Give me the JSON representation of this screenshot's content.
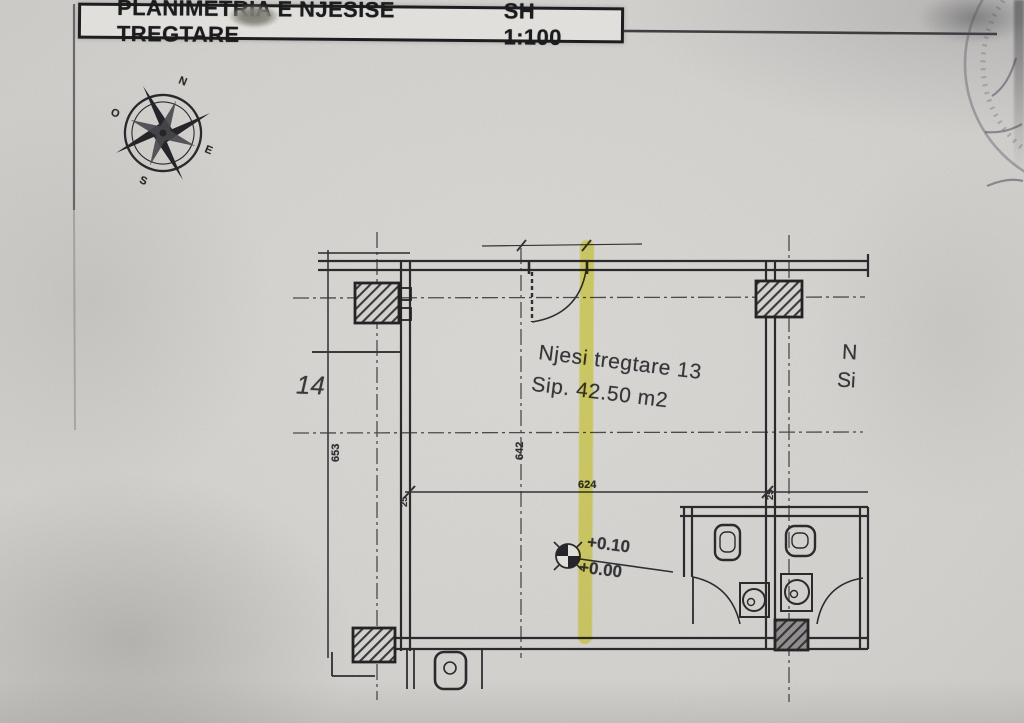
{
  "header": {
    "title": "PLANIMETRIA E NJESISE TREGTARE",
    "scale": "SH 1:100"
  },
  "compass": {
    "north": "N",
    "east": "E",
    "south": "S",
    "west": "O"
  },
  "plan": {
    "unit_name": "Njesi tregtare 13",
    "unit_area": "Sip. 42.50 m2",
    "level_upper": "+0.10",
    "level_lower": "+0.00",
    "dim_width": "624",
    "dim_depth_left": "653",
    "dim_depth_center": "642",
    "wall_thickness_left": "25",
    "wall_thickness_right": "25",
    "adjacent_unit": "14",
    "adjacent_text_line1": "N",
    "adjacent_text_line2": "Si"
  },
  "colors": {
    "highlighter": "#e9e426",
    "ink": "#2b2b2e",
    "paper": "#d7d5d2"
  }
}
